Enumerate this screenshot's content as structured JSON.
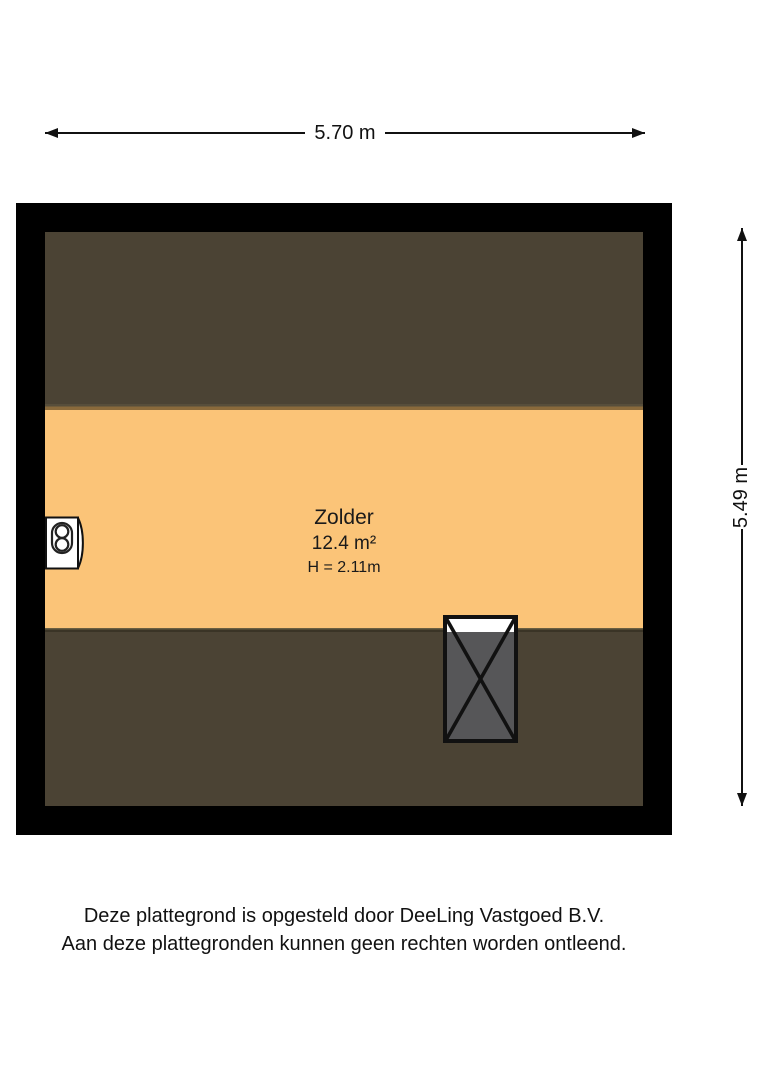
{
  "dimensions": {
    "width_label": "5.70 m",
    "height_label": "5.49 m"
  },
  "room": {
    "name": "Zolder",
    "area": "12.4 m²",
    "ceiling_height": "H = 2.11m"
  },
  "footer": {
    "line1": "Deze plattegrond is opgesteld door DeeLing Vastgoed B.V.",
    "line2": "Aan deze plattegronden kunnen geen rechten worden ontleend."
  },
  "icons": {
    "boiler": "boiler-icon",
    "staircase": "staircase-icon"
  },
  "colors": {
    "wall": "#000000",
    "floor": "#FBC478",
    "low_headroom": "#4B4334",
    "stairs_fill": "#565658",
    "line": "#111111"
  }
}
